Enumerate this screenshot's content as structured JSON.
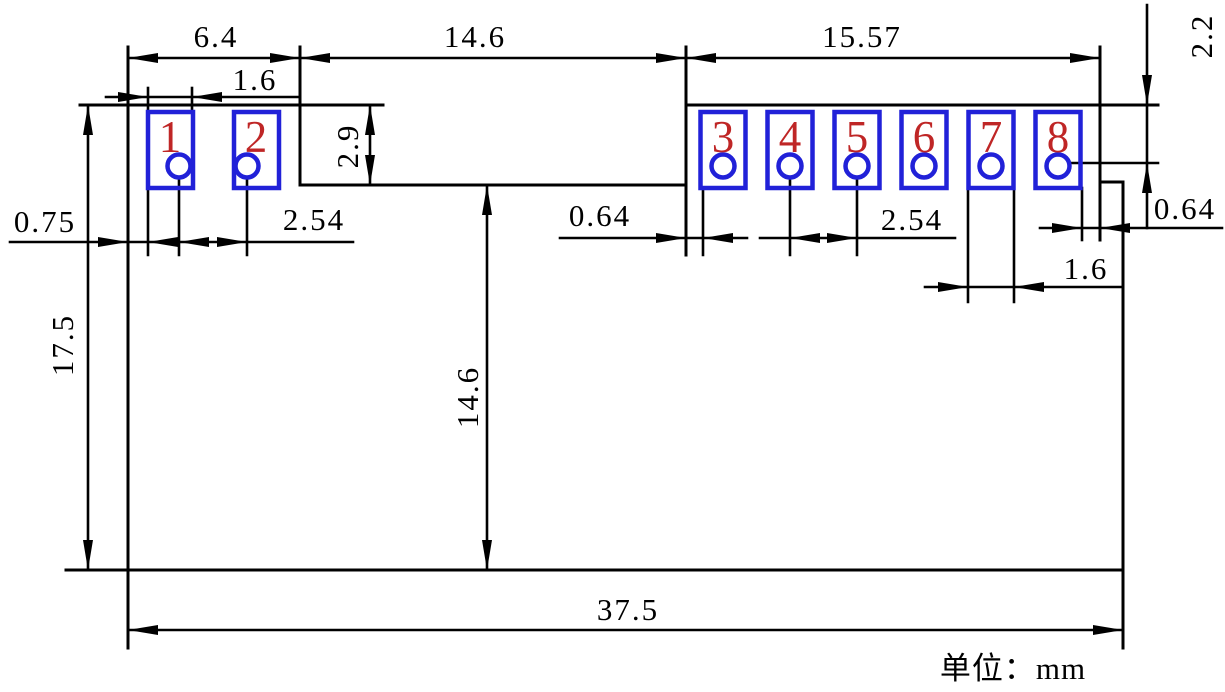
{
  "unit_label": "单位：mm",
  "pads": [
    {
      "number": "1"
    },
    {
      "number": "2"
    },
    {
      "number": "3"
    },
    {
      "number": "4"
    },
    {
      "number": "5"
    },
    {
      "number": "6"
    },
    {
      "number": "7"
    },
    {
      "number": "8"
    }
  ],
  "dims": {
    "left_section_width": "6.4",
    "pad_width_top": "1.6",
    "notch_width": "14.6",
    "right_section_width": "15.57",
    "top_edge_to_hole": "2.2",
    "notch_depth": "2.9",
    "left_edge_to_pad": "0.75",
    "hole_pitch_left": "2.54",
    "edge_to_pad_gap_mid": "0.64",
    "hole_pitch_right": "2.54",
    "edge_to_pad_gap_right": "0.64",
    "pad_width_bottom": "1.6",
    "body_height": "17.5",
    "notch_to_bottom": "14.6",
    "body_width": "37.5"
  },
  "colors": {
    "line": "#000000",
    "pad_outline": "#2121d8",
    "pad_number": "#bf2626",
    "hole_fill": "#ffffff"
  }
}
